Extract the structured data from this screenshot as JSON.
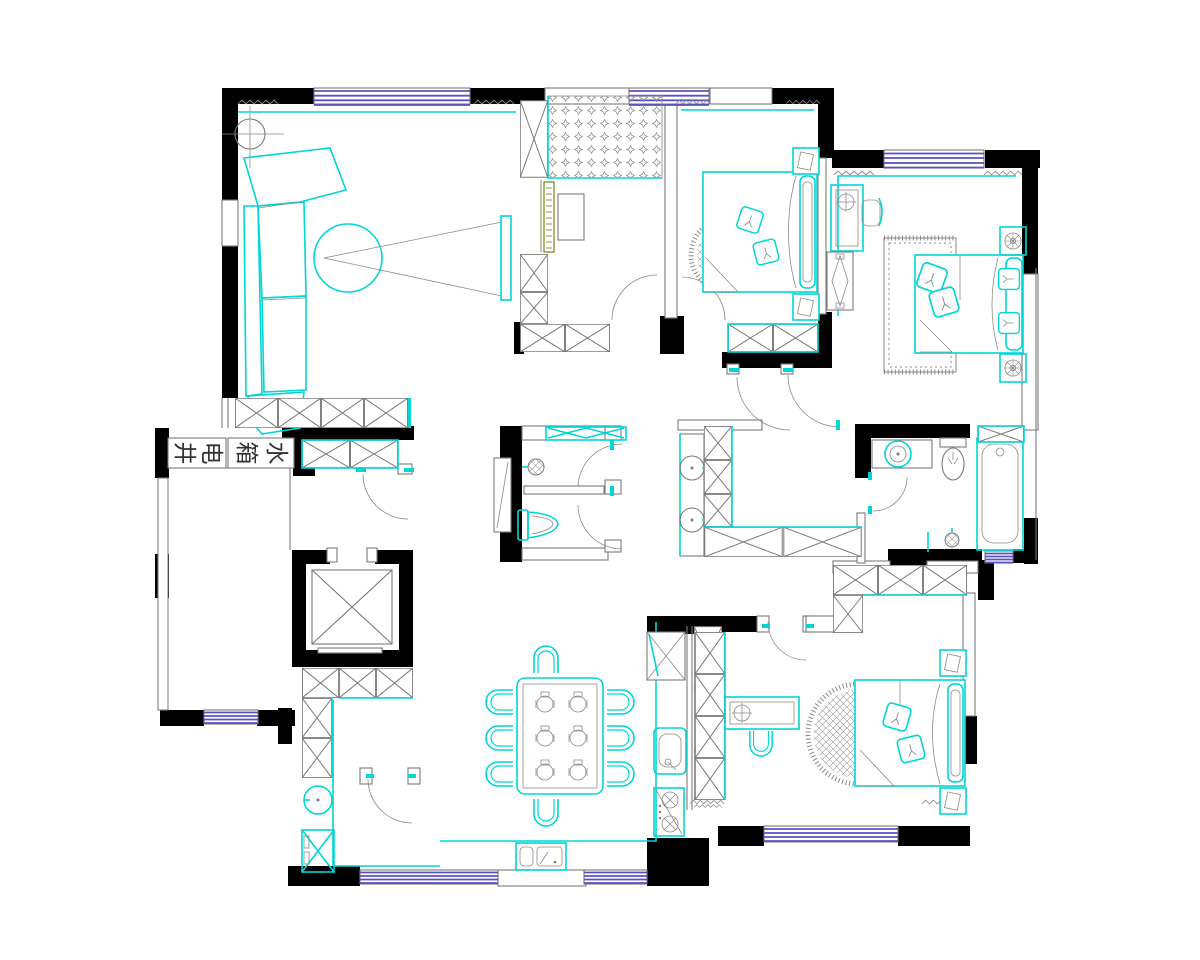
{
  "labels": {
    "electrical_shaft": "电井",
    "water_tank": "水箱",
    "elec_c1": "井",
    "elec_c2": "电",
    "water_c1": "箱",
    "water_c2": "水"
  },
  "palette": {
    "background": "#ffffff",
    "wall": "#000000",
    "window": "#5a52c0",
    "furniture_accent": "#00d6d6",
    "drawing_line": "#7a7a7a",
    "tv_board": "#6d7500"
  },
  "fixtures": [
    "sofa",
    "tv",
    "tv-viewing-cone",
    "plant-circle",
    "tatami-bed",
    "wardrobe",
    "double-bed",
    "round-rug",
    "nightstand",
    "table-lamp",
    "desk",
    "desk-chair",
    "shower-drain",
    "toilet",
    "wash-basin",
    "bathtub",
    "mirror-cabinet",
    "dining-table",
    "dining-chair",
    "place-setting",
    "kitchen-sink",
    "gas-stove",
    "corner-cabinet",
    "washing-machine",
    "elevator",
    "window",
    "door-arc",
    "shoe-cabinet"
  ]
}
